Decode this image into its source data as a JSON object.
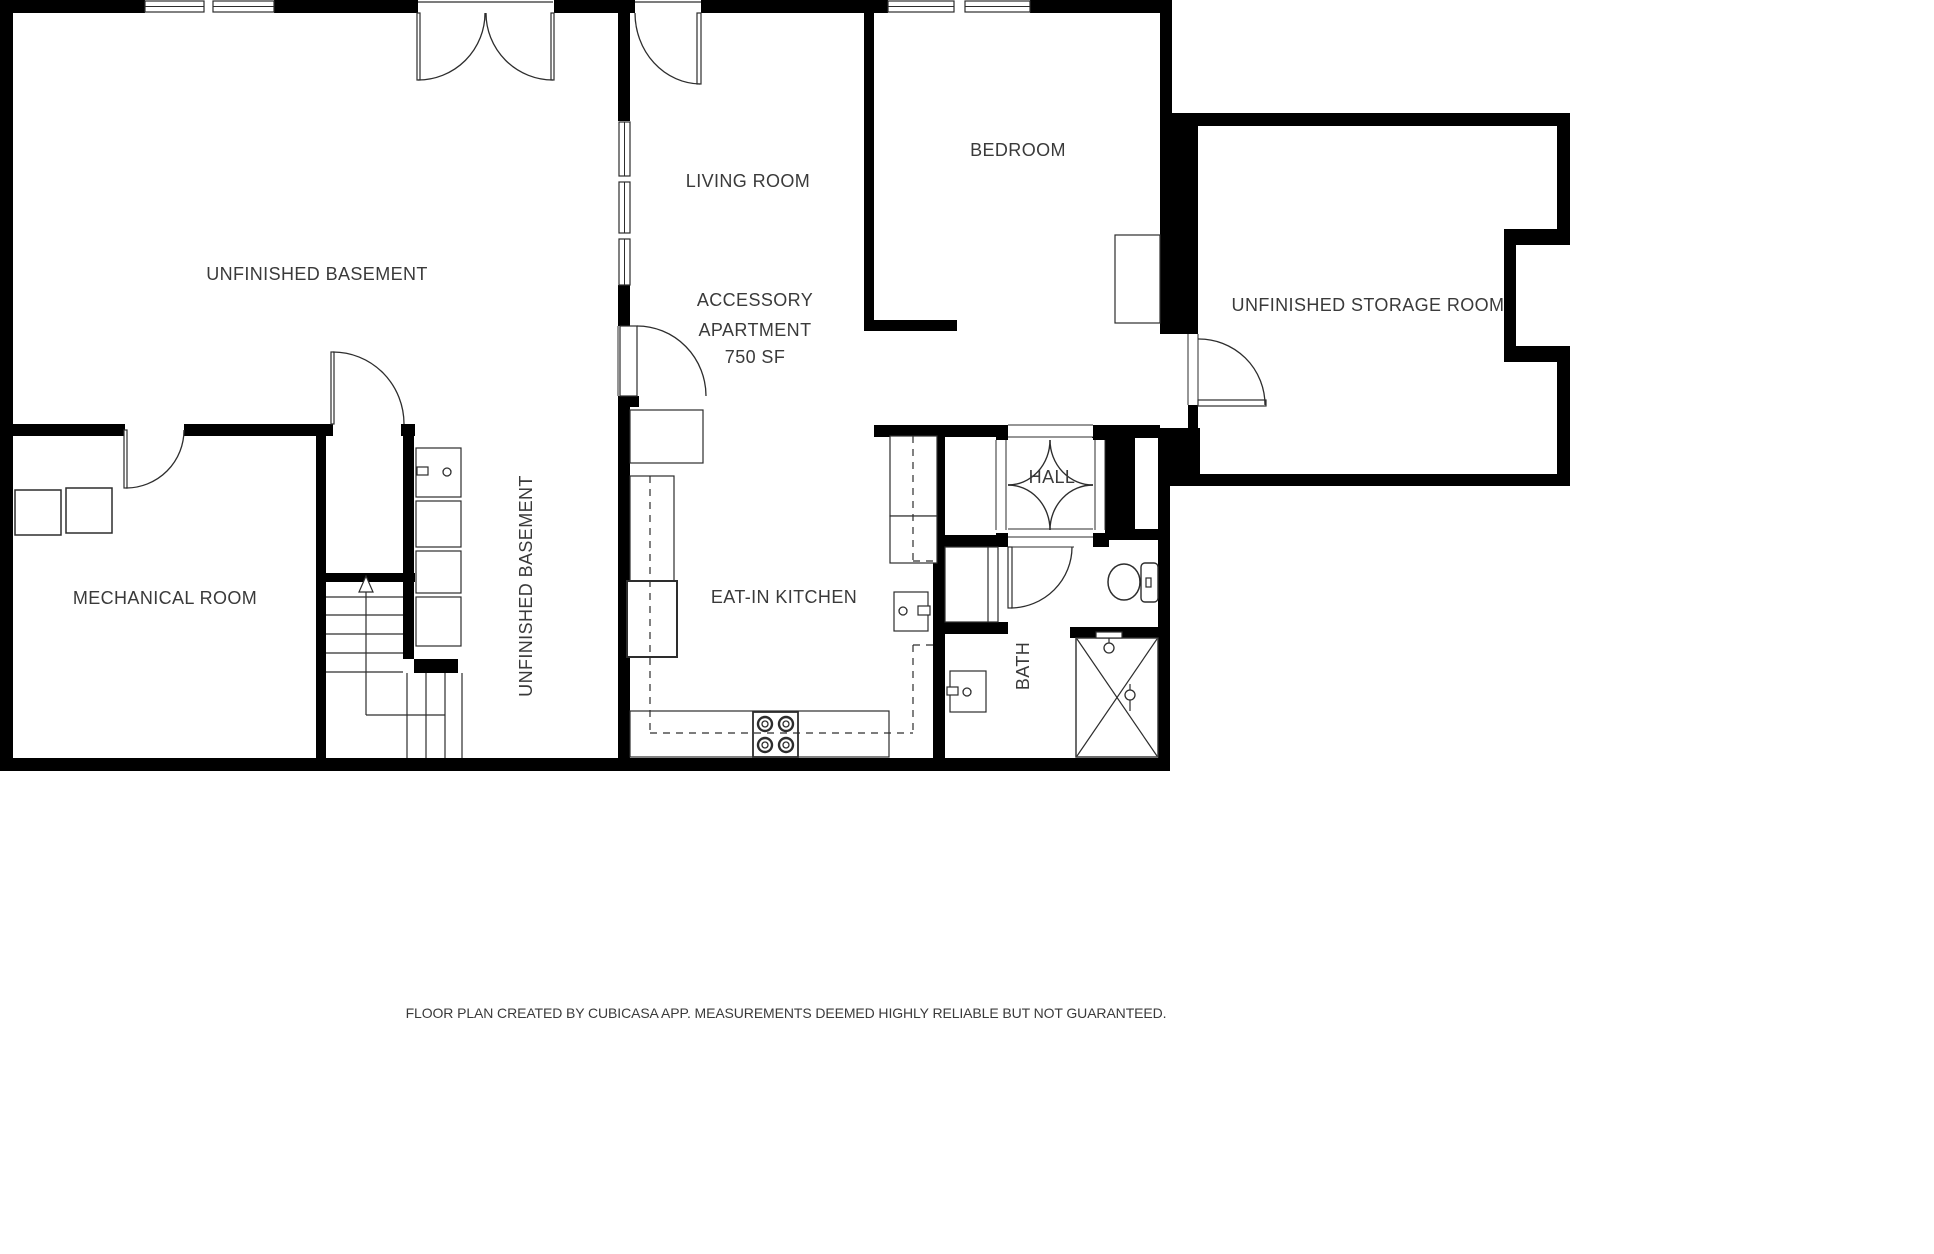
{
  "page": {
    "footer": "FLOOR PLAN CREATED BY CUBICASA APP. MEASUREMENTS DEEMED HIGHLY RELIABLE BUT NOT GUARANTEED.",
    "background": "#ffffff",
    "wall_color": "#000000",
    "line_color": "#2d2d2d",
    "text_color": "#3a3a3a"
  },
  "labels": [
    {
      "id": "unfinished-basement",
      "text": "UNFINISHED BASEMENT",
      "x": 317,
      "y": 274,
      "rot": 0
    },
    {
      "id": "living-room",
      "text": "LIVING ROOM",
      "x": 748,
      "y": 181,
      "rot": 0
    },
    {
      "id": "accessory-apartment-1",
      "text": "ACCESSORY",
      "x": 755,
      "y": 300,
      "rot": 0
    },
    {
      "id": "accessory-apartment-2",
      "text": "APARTMENT",
      "x": 755,
      "y": 330,
      "rot": 0
    },
    {
      "id": "accessory-apartment-sf",
      "text": "750 SF",
      "x": 755,
      "y": 357,
      "rot": 0
    },
    {
      "id": "bedroom",
      "text": "BEDROOM",
      "x": 1018,
      "y": 150,
      "rot": 0
    },
    {
      "id": "unfinished-storage-room",
      "text": "UNFINISHED STORAGE ROOM",
      "x": 1368,
      "y": 305,
      "rot": 0
    },
    {
      "id": "mechanical-room",
      "text": "MECHANICAL ROOM",
      "x": 165,
      "y": 598,
      "rot": 0
    },
    {
      "id": "unfinished-basement-vertical",
      "text": "UNFINISHED BASEMENT",
      "x": 526,
      "y": 586,
      "rot": -90
    },
    {
      "id": "eat-in-kitchen",
      "text": "EAT-IN KITCHEN",
      "x": 784,
      "y": 597,
      "rot": 0
    },
    {
      "id": "hall",
      "text": "HALL",
      "x": 1052,
      "y": 477,
      "rot": 0
    },
    {
      "id": "bath",
      "text": "BATH",
      "x": 1023,
      "y": 666,
      "rot": -90
    }
  ],
  "plan": {
    "walls": [
      [
        0,
        0,
        13,
        771
      ],
      [
        0,
        0,
        145,
        13
      ],
      [
        274,
        0,
        144,
        13
      ],
      [
        554,
        0,
        81,
        13
      ],
      [
        701,
        0,
        187,
        13
      ],
      [
        1030,
        0,
        142,
        13
      ],
      [
        0,
        758,
        1170,
        13
      ],
      [
        618,
        13,
        12,
        108
      ],
      [
        618,
        285,
        12,
        41
      ],
      [
        618,
        396,
        12,
        362
      ],
      [
        630,
        396,
        9,
        11
      ],
      [
        864,
        13,
        10,
        318
      ],
      [
        864,
        320,
        93,
        11
      ],
      [
        1160,
        13,
        12,
        100
      ],
      [
        1160,
        113,
        38,
        221
      ],
      [
        1172,
        113,
        398,
        13
      ],
      [
        1557,
        126,
        13,
        103
      ],
      [
        1504,
        229,
        66,
        16
      ],
      [
        1504,
        245,
        12,
        101
      ],
      [
        1504,
        346,
        66,
        16
      ],
      [
        1557,
        362,
        13,
        124
      ],
      [
        1198,
        474,
        372,
        12
      ],
      [
        1188,
        405,
        10,
        23
      ],
      [
        1158,
        428,
        42,
        58
      ],
      [
        1158,
        486,
        12,
        272
      ],
      [
        0,
        424,
        125,
        12
      ],
      [
        184,
        424,
        142,
        12
      ],
      [
        316,
        424,
        10,
        334
      ],
      [
        326,
        424,
        7,
        12
      ],
      [
        401,
        424,
        14,
        12
      ],
      [
        403,
        424,
        11,
        235
      ],
      [
        316,
        573,
        99,
        9
      ],
      [
        414,
        659,
        44,
        14
      ],
      [
        874,
        425,
        136,
        12
      ],
      [
        1092,
        425,
        68,
        13
      ],
      [
        1105,
        426,
        30,
        107
      ],
      [
        1109,
        529,
        49,
        11
      ],
      [
        996,
        425,
        12,
        15
      ],
      [
        1093,
        425,
        12,
        15
      ],
      [
        996,
        533,
        12,
        14
      ],
      [
        1093,
        533,
        16,
        14
      ],
      [
        933,
        436,
        12,
        322
      ],
      [
        943,
        535,
        65,
        12
      ],
      [
        937,
        622,
        71,
        12
      ],
      [
        1070,
        627,
        88,
        11
      ]
    ],
    "windows": [
      {
        "x": 145,
        "y": 1,
        "w": 59,
        "h": 11,
        "o": "h"
      },
      {
        "x": 213,
        "y": 1,
        "w": 61,
        "h": 11,
        "o": "h"
      },
      {
        "x": 888,
        "y": 1,
        "w": 66,
        "h": 11,
        "o": "h"
      },
      {
        "x": 965,
        "y": 1,
        "w": 65,
        "h": 11,
        "o": "h"
      },
      {
        "x": 619,
        "y": 122,
        "w": 11,
        "h": 54,
        "o": "v"
      },
      {
        "x": 619,
        "y": 182,
        "w": 11,
        "h": 51,
        "o": "v"
      },
      {
        "x": 619,
        "y": 239,
        "w": 11,
        "h": 46,
        "o": "v"
      }
    ],
    "jambs": [
      {
        "x": 996,
        "y": 440,
        "w": 10,
        "h": 90,
        "o": "v"
      },
      {
        "x": 1095,
        "y": 440,
        "w": 10,
        "h": 90,
        "o": "v"
      },
      {
        "x": 1008,
        "y": 425,
        "w": 85,
        "h": 12,
        "o": "h"
      },
      {
        "x": 1008,
        "y": 529,
        "w": 85,
        "h": 8,
        "o": "h"
      },
      {
        "x": 1008,
        "y": 537,
        "w": 66,
        "h": 10,
        "o": "h"
      },
      {
        "x": 1188,
        "y": 334,
        "w": 10,
        "h": 71,
        "o": "v"
      },
      {
        "x": 618,
        "y": 326,
        "w": 12,
        "h": 70,
        "o": "v"
      }
    ],
    "doors": [
      {
        "name": "double-door-basement-left",
        "p": [
          417,
          13,
          3,
          67
        ],
        "a": "M 485,13 A 67 67 0 0 1 418,80"
      },
      {
        "name": "double-door-basement-right",
        "p": [
          551,
          13,
          3,
          67
        ],
        "a": "M 486,13 A 67 67 0 0 0 553,80"
      },
      {
        "name": "door-living-room",
        "p": [
          697,
          13,
          4,
          71
        ],
        "a": "M 635,13 A 66 71 0 0 0 700,84"
      },
      {
        "name": "door-apartment",
        "p": [
          620,
          326,
          17,
          70
        ],
        "a": "M 637,326 A 69 70 0 0 1 706,396"
      },
      {
        "name": "door-mechanical",
        "p": [
          124,
          430,
          3,
          58
        ],
        "a": "M 184,430 A 58 58 0 0 1 126,488"
      },
      {
        "name": "door-stairs",
        "p": [
          331,
          352,
          3,
          72
        ],
        "a": "M 333,352 A 71 72 0 0 1 404,424"
      },
      {
        "name": "door-bath",
        "p": [
          1008,
          547,
          4,
          61
        ],
        "a": "M 1072,547 A 62 61 0 0 1 1011,608"
      },
      {
        "name": "door-storage",
        "p": [
          1198,
          400,
          68,
          6
        ],
        "a": "M 1198,339 A 66 66 0 0 1 1265,405"
      }
    ],
    "arcs": [
      {
        "name": "hall-arch-tl",
        "d": "M 1050,440 A 42 45 0 0 1 1008,485"
      },
      {
        "name": "hall-arch-tr",
        "d": "M 1050,440 A 43 45 0 0 0 1093,485"
      },
      {
        "name": "hall-arch-br",
        "d": "M 1093,485 A 43 45 0 0 0 1050,530"
      },
      {
        "name": "hall-arch-bl",
        "d": "M 1050,530 A 42 45 0 0 0 1008,485"
      }
    ],
    "boxes": [
      {
        "name": "mech-equipment-1",
        "x": 15,
        "y": 490,
        "w": 46,
        "h": 45,
        "sw": 1.5
      },
      {
        "name": "mech-equipment-2",
        "x": 66,
        "y": 488,
        "w": 46,
        "h": 45,
        "sw": 1.5
      },
      {
        "name": "utility-sink-unit",
        "x": 416,
        "y": 448,
        "w": 45,
        "h": 49,
        "sw": 1.2
      },
      {
        "name": "laundry-unit-1",
        "x": 416,
        "y": 501,
        "w": 45,
        "h": 46,
        "sw": 1.2
      },
      {
        "name": "laundry-unit-2",
        "x": 416,
        "y": 551,
        "w": 45,
        "h": 42,
        "sw": 1.2
      },
      {
        "name": "laundry-unit-3",
        "x": 416,
        "y": 597,
        "w": 45,
        "h": 49,
        "sw": 1.2
      },
      {
        "name": "pass-through-box",
        "x": 630,
        "y": 410,
        "w": 73,
        "h": 53,
        "sw": 1.2
      },
      {
        "name": "kitchen-cabinet-left",
        "x": 630,
        "y": 476,
        "w": 44,
        "h": 105,
        "sw": 1.2
      },
      {
        "name": "kitchen-fridge",
        "x": 627,
        "y": 581,
        "w": 50,
        "h": 76,
        "sw": 2
      },
      {
        "name": "kitchen-counter-bottom",
        "x": 630,
        "y": 711,
        "w": 259,
        "h": 46,
        "sw": 1.2
      },
      {
        "name": "kitchen-cabinet-right-1",
        "x": 890,
        "y": 436,
        "w": 47,
        "h": 80,
        "sw": 1.2
      },
      {
        "name": "kitchen-cabinet-right-2",
        "x": 890,
        "y": 516,
        "w": 47,
        "h": 47,
        "sw": 1.2
      },
      {
        "name": "kitchen-sink",
        "x": 894,
        "y": 592,
        "w": 34,
        "h": 39,
        "sw": 1.2
      },
      {
        "name": "kitchen-sink-handle",
        "x": 918,
        "y": 606,
        "w": 12,
        "h": 9,
        "sw": 1.2
      },
      {
        "name": "stove",
        "x": 753,
        "y": 712,
        "w": 45,
        "h": 45,
        "sw": 1.8
      },
      {
        "name": "bedroom-closet",
        "x": 1115,
        "y": 235,
        "w": 45,
        "h": 88,
        "sw": 1.2
      },
      {
        "name": "bath-niche",
        "x": 945,
        "y": 547,
        "w": 53,
        "h": 75,
        "sw": 1.2
      },
      {
        "name": "bath-vanity",
        "x": 950,
        "y": 671,
        "w": 36,
        "h": 41,
        "sw": 1.2
      },
      {
        "name": "bath-vanity-handle",
        "x": 947,
        "y": 687,
        "w": 11,
        "h": 8,
        "sw": 1.2
      },
      {
        "name": "utility-sink-handle",
        "x": 417,
        "y": 467,
        "w": 11,
        "h": 8,
        "sw": 1.2
      },
      {
        "name": "toilet-tank",
        "x": 1141,
        "y": 563,
        "w": 17,
        "h": 39,
        "sw": 1.4,
        "rx": 4
      },
      {
        "name": "toilet-button",
        "x": 1146,
        "y": 578,
        "w": 5,
        "h": 9,
        "sw": 1.2
      },
      {
        "name": "shower",
        "x": 1076,
        "y": 638,
        "w": 82,
        "h": 119,
        "sw": 1.4
      },
      {
        "name": "shower-head-bar",
        "x": 1096,
        "y": 632,
        "w": 26,
        "h": 6,
        "sw": 1.2
      }
    ],
    "lines": [
      [
        326,
        597,
        403,
        597
      ],
      [
        326,
        615,
        403,
        615
      ],
      [
        326,
        634,
        403,
        634
      ],
      [
        326,
        653,
        403,
        653
      ],
      [
        326,
        672,
        403,
        672
      ],
      [
        407,
        673,
        407,
        758
      ],
      [
        426,
        673,
        426,
        758
      ],
      [
        445,
        673,
        445,
        758
      ],
      [
        462,
        673,
        462,
        758
      ],
      [
        366,
        590,
        366,
        715
      ],
      [
        366,
        715,
        445,
        715
      ],
      [
        1077,
        639,
        1157,
        756
      ],
      [
        1157,
        639,
        1077,
        756
      ],
      [
        1109,
        638,
        1109,
        645
      ],
      [
        1130,
        684,
        1130,
        711
      ],
      [
        988,
        547,
        988,
        622
      ],
      [
        418,
        2,
        553,
        2
      ],
      [
        635,
        2,
        701,
        2
      ]
    ],
    "dashed": [
      [
        650,
        476,
        650,
        733
      ],
      [
        650,
        733,
        913,
        733
      ],
      [
        913,
        436,
        913,
        561
      ],
      [
        913,
        561,
        933,
        561
      ],
      [
        913,
        645,
        933,
        645
      ],
      [
        913,
        645,
        913,
        733
      ]
    ],
    "circles": [
      {
        "name": "stove-burner",
        "cx": 765,
        "cy": 724,
        "r": 7,
        "sw": 2.4
      },
      {
        "name": "stove-burner",
        "cx": 786,
        "cy": 724,
        "r": 7,
        "sw": 2.4
      },
      {
        "name": "stove-burner",
        "cx": 765,
        "cy": 745,
        "r": 7,
        "sw": 2.4
      },
      {
        "name": "stove-burner",
        "cx": 786,
        "cy": 745,
        "r": 7,
        "sw": 2.4
      },
      {
        "name": "stove-burner-inner",
        "cx": 765,
        "cy": 724,
        "r": 3,
        "sw": 1.3
      },
      {
        "name": "stove-burner-inner",
        "cx": 786,
        "cy": 724,
        "r": 3,
        "sw": 1.3
      },
      {
        "name": "stove-burner-inner",
        "cx": 765,
        "cy": 745,
        "r": 3,
        "sw": 1.3
      },
      {
        "name": "stove-burner-inner",
        "cx": 786,
        "cy": 745,
        "r": 3,
        "sw": 1.3
      },
      {
        "name": "kitchen-sink-faucet",
        "cx": 903,
        "cy": 611,
        "r": 4,
        "sw": 1.3
      },
      {
        "name": "bath-vanity-faucet",
        "cx": 967,
        "cy": 692,
        "r": 4,
        "sw": 1.3
      },
      {
        "name": "utility-sink-faucet",
        "cx": 447,
        "cy": 472,
        "r": 4,
        "sw": 1.3
      },
      {
        "name": "shower-head",
        "cx": 1109,
        "cy": 648,
        "r": 5,
        "sw": 1.3
      },
      {
        "name": "shower-mixer",
        "cx": 1130,
        "cy": 695,
        "r": 5,
        "sw": 1.3
      }
    ],
    "ellipses": [
      {
        "name": "toilet-bowl",
        "cx": 1124,
        "cy": 582,
        "rx": 16,
        "ry": 18,
        "sw": 1.5
      }
    ],
    "polygons": [
      {
        "name": "stairs-up-arrowhead",
        "pts": "366,576 359,592 373,592",
        "sw": 1.2
      }
    ]
  }
}
